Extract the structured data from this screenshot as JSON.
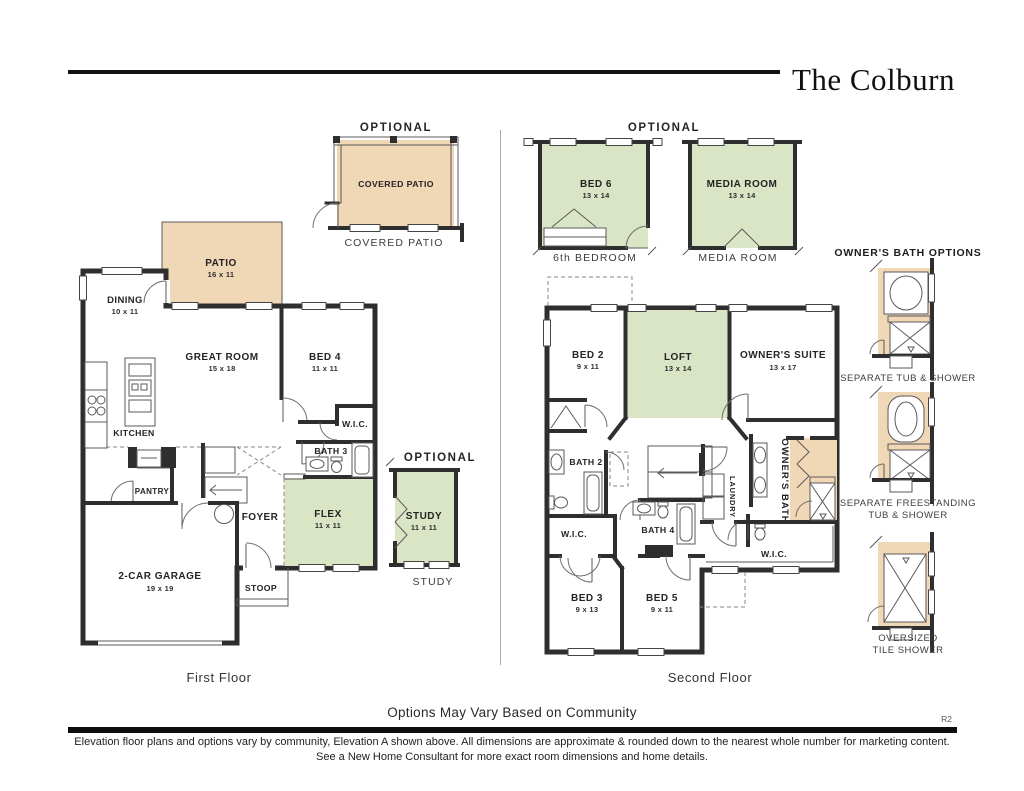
{
  "header": {
    "title": "The Colburn"
  },
  "first_floor": {
    "caption": "First Floor",
    "covered_patio_option": {
      "optional": "OPTIONAL",
      "name": "COVERED PATIO",
      "caption": "COVERED PATIO"
    },
    "rooms": {
      "patio": {
        "name": "PATIO",
        "dims": "16 x 11"
      },
      "dining": {
        "name": "DINING",
        "dims": "10 x 11"
      },
      "great_room": {
        "name": "GREAT ROOM",
        "dims": "15 x 18"
      },
      "bed4": {
        "name": "BED 4",
        "dims": "11 x 11"
      },
      "kitchen": {
        "name": "KITCHEN"
      },
      "wic": {
        "name": "W.I.C."
      },
      "bath3": {
        "name": "BATH 3"
      },
      "pantry": {
        "name": "PANTRY"
      },
      "foyer": {
        "name": "FOYER"
      },
      "flex": {
        "name": "FLEX",
        "dims": "11 x 11"
      },
      "garage": {
        "name": "2-CAR GARAGE",
        "dims": "19 x 19"
      },
      "stoop": {
        "name": "STOOP"
      }
    },
    "study_option": {
      "optional": "OPTIONAL",
      "name": "STUDY",
      "dims": "11 x 11",
      "caption": "STUDY"
    }
  },
  "second_floor": {
    "caption": "Second Floor",
    "optional": "OPTIONAL",
    "bed6_option": {
      "name": "BED 6",
      "dims": "13 x 14",
      "caption": "6th BEDROOM"
    },
    "media_option": {
      "name": "MEDIA ROOM",
      "dims": "13 x 14",
      "caption": "MEDIA ROOM"
    },
    "rooms": {
      "bed2": {
        "name": "BED 2",
        "dims": "9 x 11"
      },
      "loft": {
        "name": "LOFT",
        "dims": "13 x 14"
      },
      "owners_suite": {
        "name": "OWNER'S SUITE",
        "dims": "13 x 17"
      },
      "bath2": {
        "name": "BATH 2"
      },
      "laundry": {
        "name": "LAUNDRY"
      },
      "owners_bath": {
        "name": "OWNER'S BATH"
      },
      "wic_left": {
        "name": "W.I.C."
      },
      "bath4": {
        "name": "BATH 4"
      },
      "wic_right": {
        "name": "W.I.C."
      },
      "bed3": {
        "name": "BED 3",
        "dims": "9 x 13"
      },
      "bed5": {
        "name": "BED 5",
        "dims": "9 x 11"
      }
    }
  },
  "bath_options": {
    "title": "OWNER'S BATH OPTIONS",
    "options": [
      {
        "line1": "SEPARATE TUB & SHOWER",
        "line2": ""
      },
      {
        "line1": "SEPARATE FREESTANDING",
        "line2": "TUB & SHOWER"
      },
      {
        "line1": "OVERSIZED",
        "line2": "TILE SHOWER"
      }
    ]
  },
  "footer": {
    "note": "Options May Vary Based on Community",
    "revision": "R2",
    "disclaimer1": "Elevation floor plans and options vary by community, Elevation A shown above. All dimensions are approximate & rounded down to the nearest whole number for marketing content.",
    "disclaimer2": "See a New Home Consultant for more exact room dimensions and home details."
  },
  "colors": {
    "accent_green": "#d9e5c5",
    "accent_tan": "#f0d7b5",
    "wall": "#2e2e2e"
  }
}
